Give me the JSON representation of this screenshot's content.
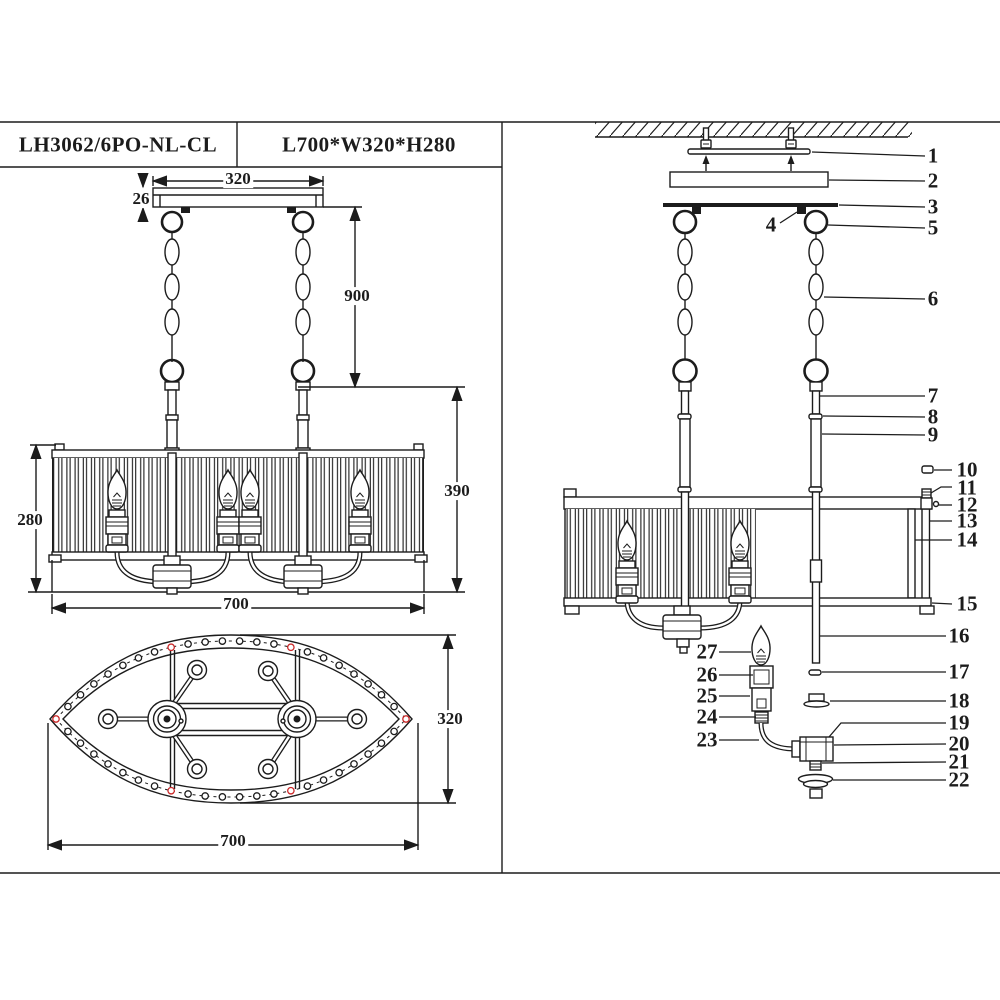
{
  "colors": {
    "line_color": "#1c1c1c",
    "accent_red": "#cc2a2a",
    "background": "#ffffff"
  },
  "title_block": {
    "model": "LH3062/6PO-NL-CL",
    "size": "L700*W320*H280"
  },
  "front_view_dims": {
    "canopy_width": "320",
    "canopy_height": "26",
    "chain_length": "900",
    "body_height": "390",
    "shade_height": "280",
    "shade_length": "700"
  },
  "plan_view_dims": {
    "width": "320",
    "length": "700"
  },
  "exploded_callouts": [
    "1",
    "2",
    "3",
    "4",
    "5",
    "6",
    "7",
    "8",
    "9",
    "10",
    "11",
    "12",
    "13",
    "14",
    "15",
    "16",
    "17",
    "18",
    "19",
    "20",
    "21",
    "22",
    "23",
    "24",
    "25",
    "26",
    "27"
  ]
}
